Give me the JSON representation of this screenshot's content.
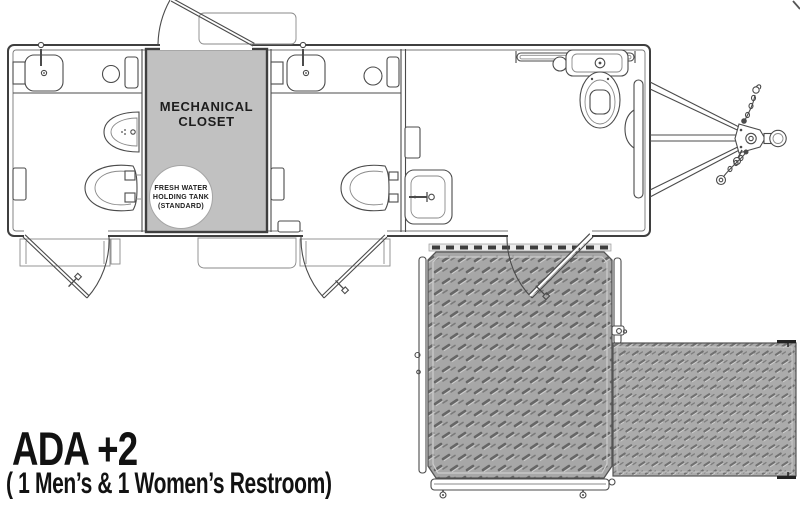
{
  "diagram": {
    "kind": "restroom trailer floor plan",
    "title": "ADA +2",
    "subtitle": "( 1 Men’s & 1 Women’s Restroom)",
    "labels": {
      "mechanical_closet": "MECHANICAL CLOSET",
      "fresh_water_tank": "FRESH WATER HOLDING TANK (STANDARD)"
    },
    "colors": {
      "background": "#ffffff",
      "line": "#4b4b4b",
      "closet_fill": "#c1c1c1",
      "platform_fill": "#a7a7a7",
      "ramp_fill": "#ababab",
      "text": "#121212"
    },
    "features": {
      "restrooms": [
        {
          "name": "men-restroom",
          "fixtures": [
            "sink",
            "waste-bin",
            "shelf",
            "urinal",
            "toilet",
            "entry-door-with-step"
          ]
        },
        {
          "name": "women-restroom",
          "fixtures": [
            "sink",
            "waste-bin",
            "shelf",
            "toilet",
            "entry-door-with-step"
          ]
        },
        {
          "name": "ada-restroom",
          "fixtures": [
            "grab-bar",
            "toilet",
            "ada-sink",
            "wall-shelf",
            "entry-door"
          ]
        }
      ],
      "exterior": [
        "mechanical-closet-access-door",
        "fold-down-step",
        "ada-platform-with-rails",
        "ada-ramp",
        "a-frame-tongue",
        "coupler-with-ball",
        "safety-chains",
        "jack-wheel"
      ]
    }
  }
}
